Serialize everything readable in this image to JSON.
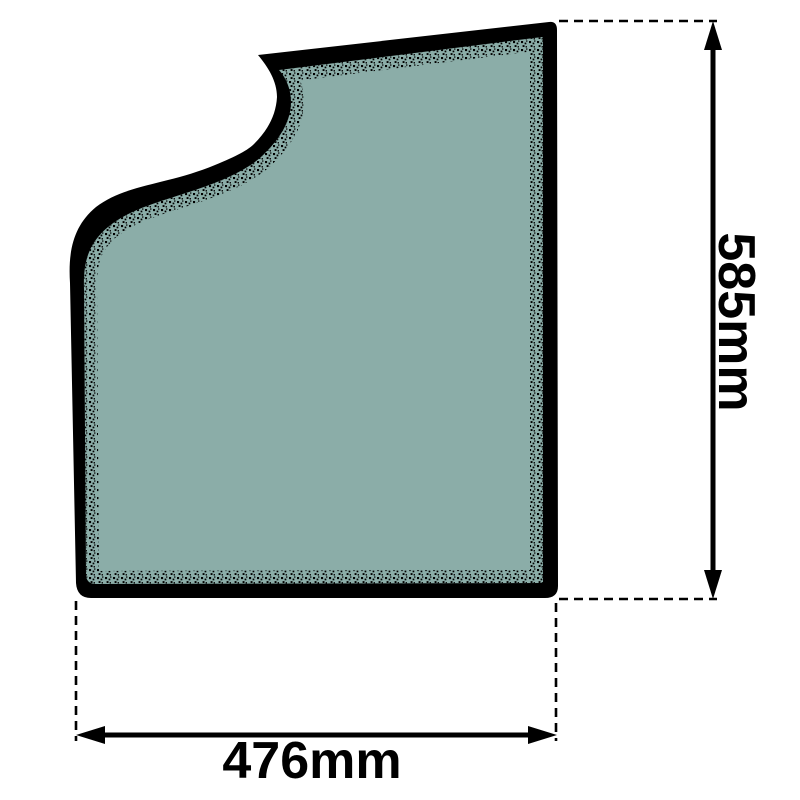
{
  "diagram": {
    "colors": {
      "glass": "#8bada8",
      "outline": "#000000",
      "dimension": "#000000",
      "background": "#ffffff"
    }
  },
  "dimensions": {
    "height": {
      "label": "585mm"
    },
    "width": {
      "label": "476mm"
    }
  }
}
